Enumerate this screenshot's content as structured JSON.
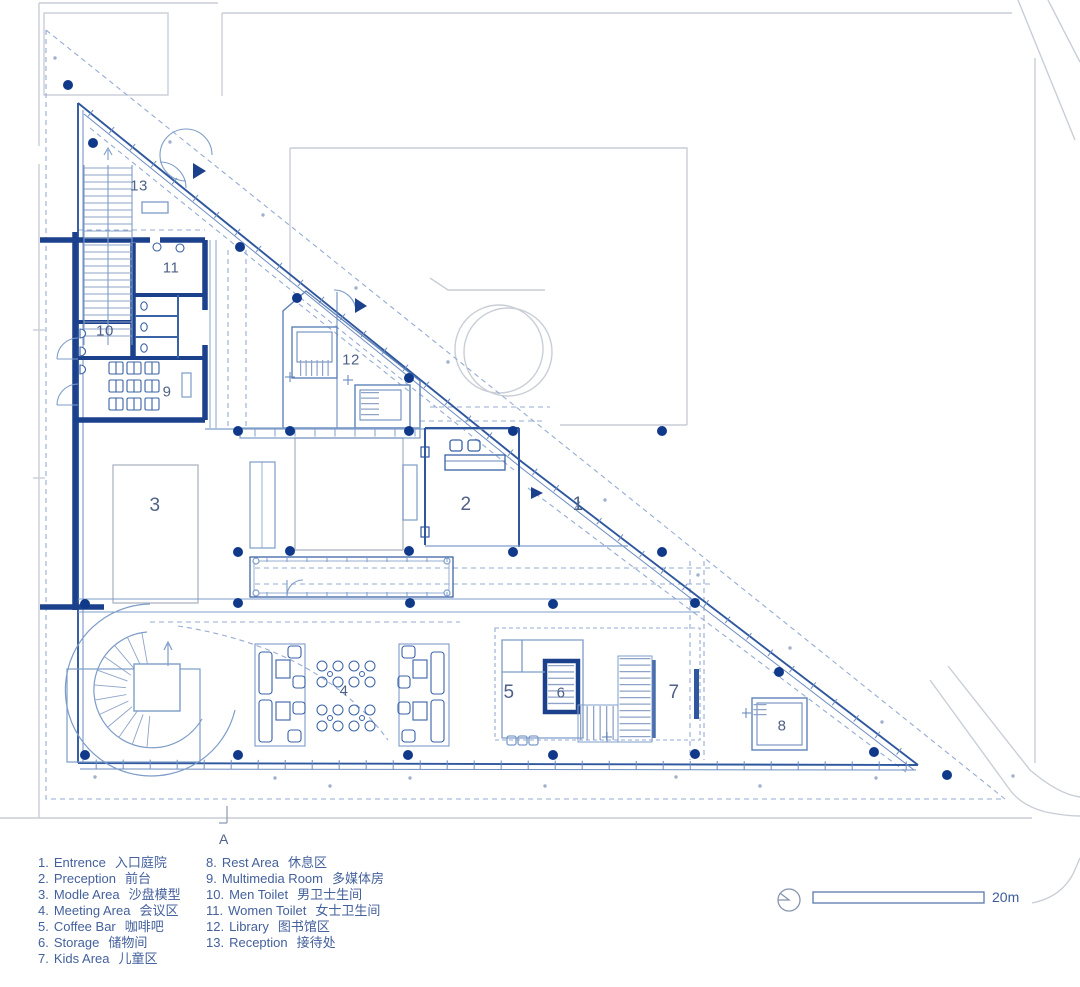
{
  "plan": {
    "room_labels": [
      "1",
      "2",
      "3",
      "4",
      "5",
      "6",
      "7",
      "8",
      "9",
      "10",
      "11",
      "12",
      "13"
    ],
    "section_label": "A",
    "scale_label": "20m"
  },
  "legend": {
    "items": [
      {
        "num": "1.",
        "en": "Entrence",
        "zh": "入口庭院"
      },
      {
        "num": "2.",
        "en": "Preception",
        "zh": "前台"
      },
      {
        "num": "3.",
        "en": "Modle Area",
        "zh": "沙盘模型"
      },
      {
        "num": "4.",
        "en": "Meeting Area",
        "zh": "会议区"
      },
      {
        "num": "5.",
        "en": "Coffee Bar",
        "zh": "咖啡吧"
      },
      {
        "num": "6.",
        "en": "Storage",
        "zh": "储物间"
      },
      {
        "num": "7.",
        "en": "Kids Area",
        "zh": "儿童区"
      },
      {
        "num": "8.",
        "en": "Rest Area",
        "zh": "休息区"
      },
      {
        "num": "9.",
        "en": "Multimedia Room",
        "zh": "多媒体房"
      },
      {
        "num": "10.",
        "en": "Men Toilet",
        "zh": "男卫士生间"
      },
      {
        "num": "11.",
        "en": "Women Toilet",
        "zh": "女士卫生间"
      },
      {
        "num": "12.",
        "en": "Library",
        "zh": "图书馆区"
      },
      {
        "num": "13.",
        "en": "Reception",
        "zh": "接待处"
      }
    ]
  },
  "icons": {
    "north_indicator": "north-indicator-icon",
    "scale_bar": "scale-bar"
  },
  "colors": {
    "wall_heavy": "#1b418d",
    "wall_main": "#2e579e",
    "line_light": "#7d9cc9",
    "dash_site": "#96abd3",
    "column_dot": "#11398a",
    "context_gray": "#c9ced6",
    "legend_text": "#44619c",
    "number_text": "#4e6187"
  }
}
